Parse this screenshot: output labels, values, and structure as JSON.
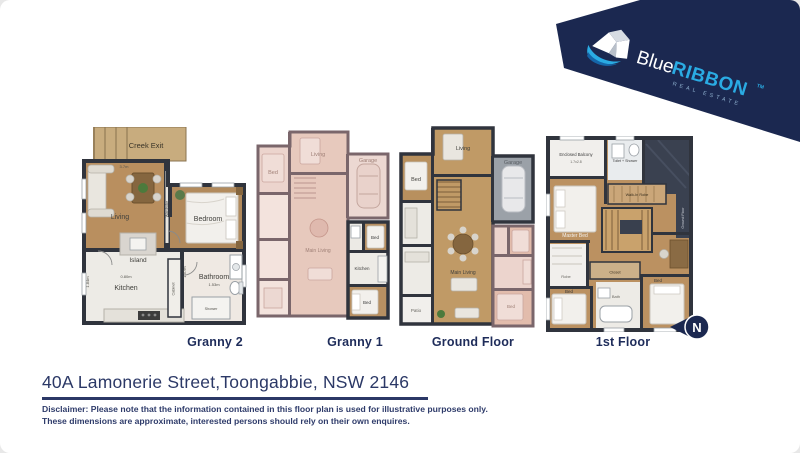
{
  "brand": {
    "name_light": "Blue",
    "name_bold": "RIBBON",
    "tm": "TM",
    "tagline": "REAL ESTATE",
    "band_color": "#1b2850",
    "accent_blue": "#2aabe3"
  },
  "compass": {
    "letter": "N"
  },
  "address": "40A Lamonerie Street,Toongabbie, NSW 2146",
  "disclaimer_line1": "Disclaimer: Please note that the information contained in this floor plan is used for illustrative purposes only.",
  "disclaimer_line2": "These dimensions are approximate, interested persons should rely on their own enquires.",
  "colors": {
    "navy_text": "#2b3866",
    "wood_floor": "#b98f5f",
    "faded_pink": "#ecd4cd",
    "garage_gray": "#9ba1a8",
    "wall_dark": "#30343d"
  },
  "plans": [
    {
      "label": "Granny 2",
      "rooms": {
        "deck": "Creek Exit",
        "living": "Living",
        "bedroom": "Bedroom",
        "island": "Island",
        "kitchen": "Kitchen",
        "bathroom": "Bathroom",
        "shower": "Shower",
        "wardrobe": "Wardrobe",
        "cabinet": "Cabinet"
      },
      "dims": {
        "top": "3.7m",
        "left": "1.84m",
        "kitchen": "0.80m",
        "bath": "1.53m",
        "mid": "1.57m"
      }
    },
    {
      "label": "Granny 1",
      "rooms": {
        "living": "Living",
        "bed": "Bed",
        "garage": "Garage",
        "main_living": "Main Living",
        "unit_bed1": "Bed",
        "unit_kitchen": "Kitchen",
        "unit_bed2": "Bed"
      }
    },
    {
      "label": "Ground Floor",
      "rooms": {
        "living": "Living",
        "bed": "Bed",
        "garage": "Garage",
        "main_living": "Main Living",
        "patio": "Patio",
        "unit_bed": "Bed"
      }
    },
    {
      "label": "1st Floor",
      "rooms": {
        "balcony": "Enclosed Balcony",
        "toilet": "Toilet + Shower",
        "master": "Master Bed",
        "robe": "Walk-In Robe",
        "robe2": "Robe",
        "closet": "Closet",
        "bath": "Bath",
        "bed1": "Bed",
        "bed2": "Bed",
        "roof": "Ground Floor"
      },
      "dims": {
        "balcony": "1.7x2.8"
      }
    }
  ]
}
